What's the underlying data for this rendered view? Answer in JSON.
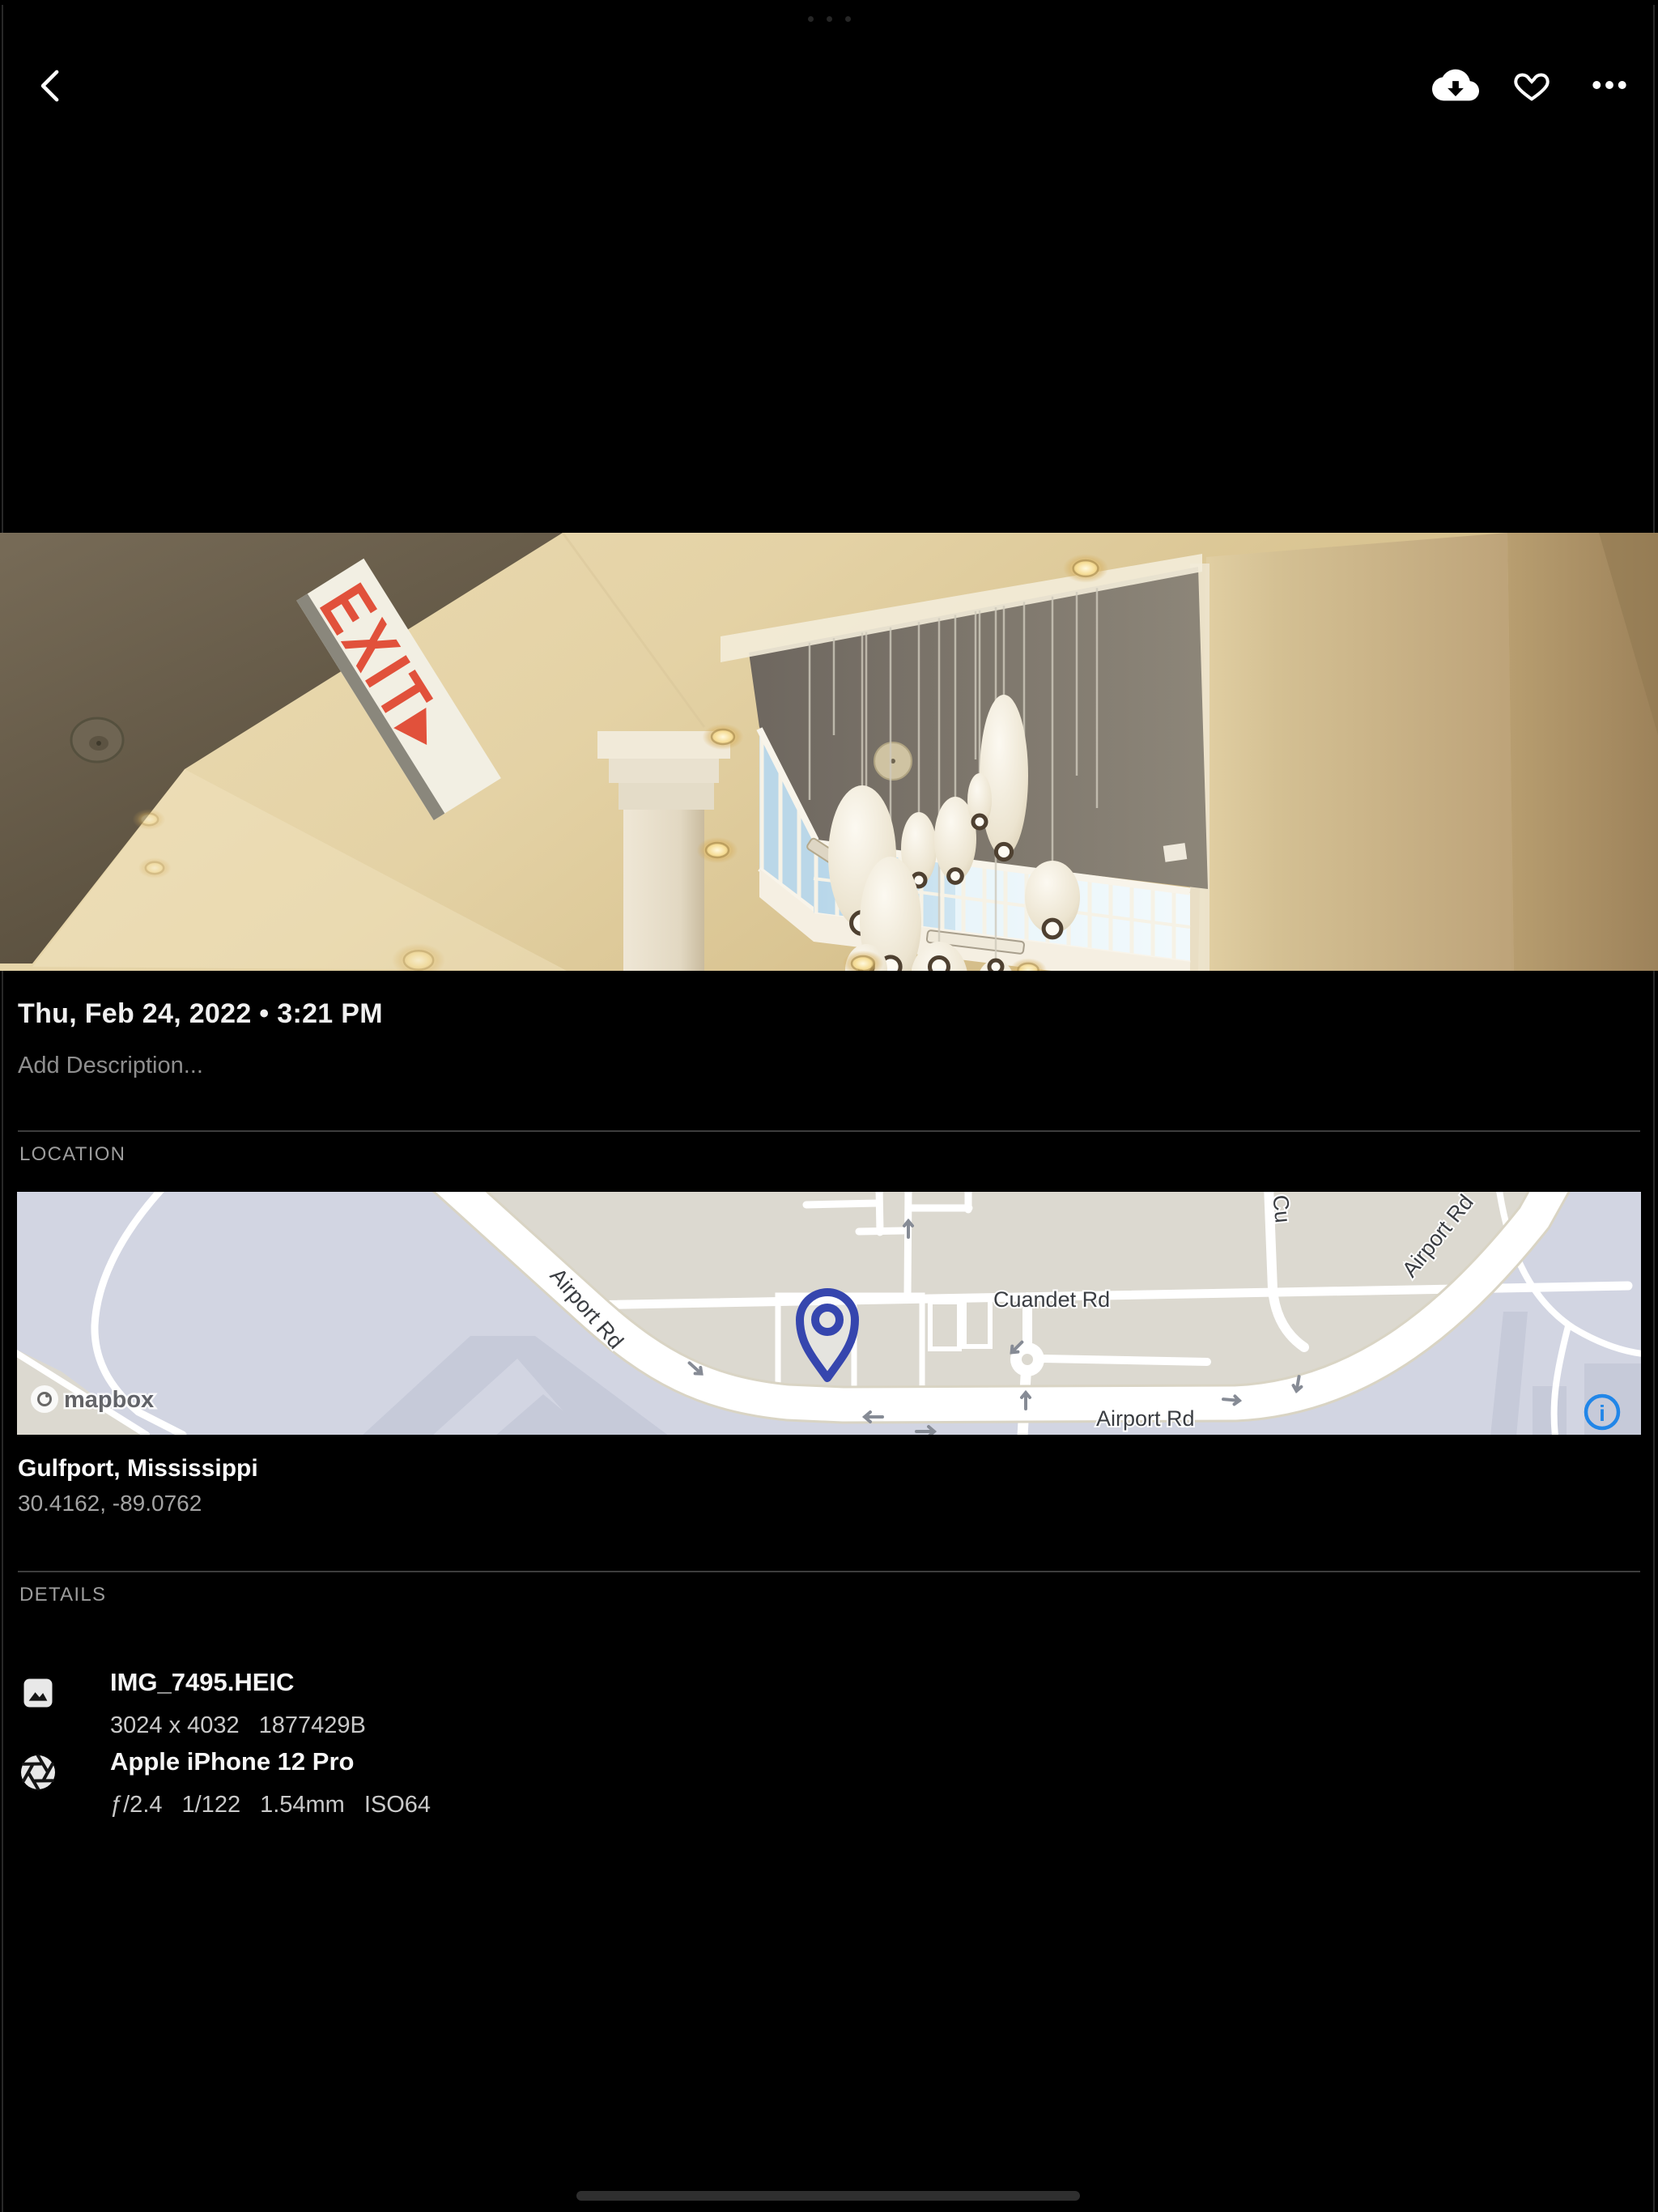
{
  "system": {
    "multitask_indicator_dots": 3
  },
  "toolbar": {
    "back_icon": "chevron-left",
    "download_icon": "cloud-download",
    "favorite_icon": "heart-outline",
    "more_icon": "ellipsis"
  },
  "photo": {
    "exit_sign_text": "EXIT▸"
  },
  "meta": {
    "datetime": "Thu, Feb 24, 2022 • 3:21 PM",
    "description_placeholder": "Add Description..."
  },
  "location": {
    "label": "LOCATION",
    "place": "Gulfport, Mississippi",
    "coordinates": "30.4162, -89.0762",
    "map": {
      "attribution": "mapbox",
      "info_icon": "i",
      "road_labels": {
        "airport_nw": "Airport Rd",
        "cuandet": "Cuandet Rd",
        "airport_south": "Airport Rd",
        "airport_ne": "Airport Rd",
        "side_street": "Cu"
      },
      "colors": {
        "land": "#dcd9d0",
        "field": "#d2d5e2",
        "pin": "#3646ae",
        "info": "#2186e8"
      }
    }
  },
  "details": {
    "label": "DETAILS",
    "file": {
      "icon": "image-icon",
      "name": "IMG_7495.HEIC",
      "dimensions": "3024 x 4032",
      "filesize": "1877429B"
    },
    "camera": {
      "icon": "aperture-icon",
      "model": "Apple iPhone 12 Pro",
      "aperture": "ƒ/2.4",
      "shutter_speed": "1/122",
      "focal_length": "1.54mm",
      "iso": "ISO64"
    }
  }
}
